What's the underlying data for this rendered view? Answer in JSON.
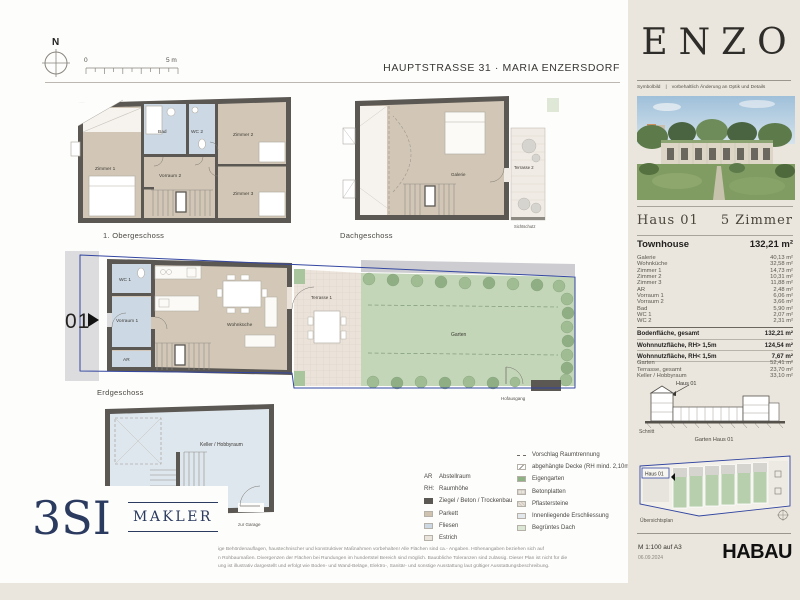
{
  "header": {
    "address": "HAUPTSTRASSE 31 · MARIA ENZERSDORF",
    "compass": "N",
    "scale_start": "0",
    "scale_end": "5 m"
  },
  "plans": {
    "og1": {
      "caption": "1. Obergeschoss",
      "zimmer1": "Zimmer 1",
      "bad": "Bad",
      "wc2": "WC 2",
      "zimmer2": "Zimmer 2",
      "vorraum2": "Vorraum 2",
      "zimmer3": "Zimmer 3"
    },
    "dg": {
      "caption": "Dachgeschoss",
      "galerie": "Galerie",
      "terrasse2": "Terrasse 2",
      "sichtschutz": "Sichtschutz"
    },
    "eg": {
      "caption": "Erdgeschoss",
      "unit": "01",
      "wc1": "WC 1",
      "vorraum1": "Vorraum 1",
      "ar": "AR",
      "wohnkueche": "Wohnküche",
      "terrasse1": "Terrasse 1",
      "garten": "Garten",
      "hofausgang": "Hofausgang"
    },
    "kg": {
      "keller": "Keller / Hobbyraum",
      "zur_garage": "zur Garage"
    }
  },
  "legend": {
    "left": [
      {
        "abbr": "AR",
        "label": "Abstellraum"
      },
      {
        "abbr": "RH:",
        "label": "Raumhöhe"
      },
      {
        "cls": "sw-wall",
        "label": "Ziegel / Beton / Trockenbau"
      },
      {
        "cls": "sw-parkett",
        "label": "Parkett"
      },
      {
        "cls": "sw-fliesen",
        "label": "Fliesen"
      },
      {
        "cls": "sw-estrich",
        "label": "Estrich"
      }
    ],
    "right": [
      {
        "cls": "sw-dashed",
        "label": "Vorschlag Raumtrennung"
      },
      {
        "cls": "sw-decke",
        "label": "abgehängte Decke (RH mind. 2,10m)"
      },
      {
        "cls": "sw-garten",
        "label": "Eigengarten"
      },
      {
        "cls": "sw-beton",
        "label": "Betonplatten"
      },
      {
        "cls": "sw-pflaster",
        "label": "Pflastersteine"
      },
      {
        "cls": "sw-innen",
        "label": "Innenliegende Erschliessung"
      },
      {
        "cls": "sw-dach",
        "label": "Begrüntes Dach"
      }
    ]
  },
  "sidebar": {
    "brand": "ENZO",
    "symbol_label": "Symbolbild",
    "symbol_sep": "|",
    "symbol_note": "vorbehaltlich Änderung an Optik und Details",
    "haus": "Haus 01",
    "zimmer": "5 Zimmer",
    "unit_type": "Townhouse",
    "unit_area": "132,21 m²",
    "rooms": [
      {
        "label": "Galerie",
        "value": "40,13 m²"
      },
      {
        "label": "Wohnküche",
        "value": "32,58 m²"
      },
      {
        "label": "Zimmer 1",
        "value": "14,73 m²"
      },
      {
        "label": "Zimmer 2",
        "value": "10,31 m²"
      },
      {
        "label": "Zimmer 3",
        "value": "11,88 m²"
      },
      {
        "label": "AR",
        "value": "2,48 m²"
      },
      {
        "label": "Vorraum 1",
        "value": "6,06 m²"
      },
      {
        "label": "Vorraum 2",
        "value": "3,66 m²"
      },
      {
        "label": "Bad",
        "value": "5,90 m²"
      },
      {
        "label": "WC 1",
        "value": "2,07 m²"
      },
      {
        "label": "WC 2",
        "value": "2,31 m²"
      }
    ],
    "total": {
      "label": "Bodenfläche, gesamt",
      "value": "132,21 m²"
    },
    "nutzflaeche": [
      {
        "label": "Wohnnutzfläche, RH> 1,5m",
        "value": "124,54 m²"
      },
      {
        "label": "Wohnnutzfläche, RH< 1,5m",
        "value": "7,67 m²"
      }
    ],
    "extras": [
      {
        "label": "Garten",
        "value": "52,41 m²"
      },
      {
        "label": "Terrasse, gesamt",
        "value": "23,70 m²"
      },
      {
        "label": "Keller / Hobbyraum",
        "value": "33,10 m²"
      }
    ],
    "section_label": "Haus 01",
    "section_caption": "Schnitt",
    "siteplan_title": "Garten Haus 01",
    "siteplan_label": "Haus 01",
    "siteplan_caption": "Übersichtsplan",
    "scale_note": "M 1:100 auf A3",
    "date": "06.09.2024",
    "partner_logo": "HABAU"
  },
  "footer": {
    "logo_text": "3SI",
    "logo_sub": "MAKLER",
    "disclaimer": [
      "ige Behördenauflagen, haustechnischer und konstruktiver Maßnahmen vorbehalten! Alle Flächen sind ca.- Angaben. Höhenangaben beziehen sich auf",
      "n Rohbaumaßen. Divergenzen der Flächen bei Rundungen im hundertstel Bereich sind möglich. Bauübliche Toleranzen sind zulässig. Dieser Plan ist nicht für die",
      "ung ist illustrativ dargestellt und erfolgt wie Boden- und Wand-Beläge, Elektro-, Sanitär- und sonstige Ausstattung laut gültiger Ausstattungsbeschreibung."
    ]
  }
}
